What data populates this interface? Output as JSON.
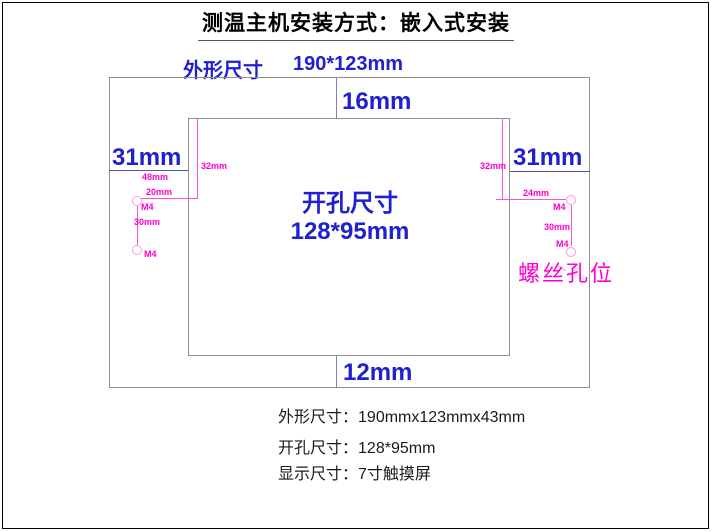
{
  "title": "测温主机安装方式：嵌入式安装",
  "colors": {
    "dimension_blue": "#2020cf",
    "annotation_magenta": "#ff00cc",
    "rect_border_gray": "#909090"
  },
  "outline_label": {
    "name": "外形尺寸",
    "value": "190*123mm"
  },
  "cutout_label": {
    "line1": "开孔尺寸",
    "line2": "128*95mm"
  },
  "margins": {
    "top": "16mm",
    "bottom": "12mm",
    "left": "31mm",
    "right": "31mm"
  },
  "screw_dims": {
    "left": {
      "edge_offset": "48mm",
      "hole_offset": "20mm",
      "depth": "32mm",
      "pitch": "30mm",
      "thread_top": "M4",
      "thread_bottom": "M4"
    },
    "right": {
      "hole_offset": "24mm",
      "depth": "32mm",
      "pitch": "30mm",
      "thread_top": "M4",
      "thread_bottom": "M4"
    },
    "caption": "螺丝孔位"
  },
  "specs": [
    {
      "label": "外形尺寸：",
      "value": "190mmx123mmx43mm"
    },
    {
      "label": "开孔尺寸：",
      "value": "128*95mm"
    },
    {
      "label": "显示尺寸：",
      "value": "7寸触摸屏"
    }
  ]
}
